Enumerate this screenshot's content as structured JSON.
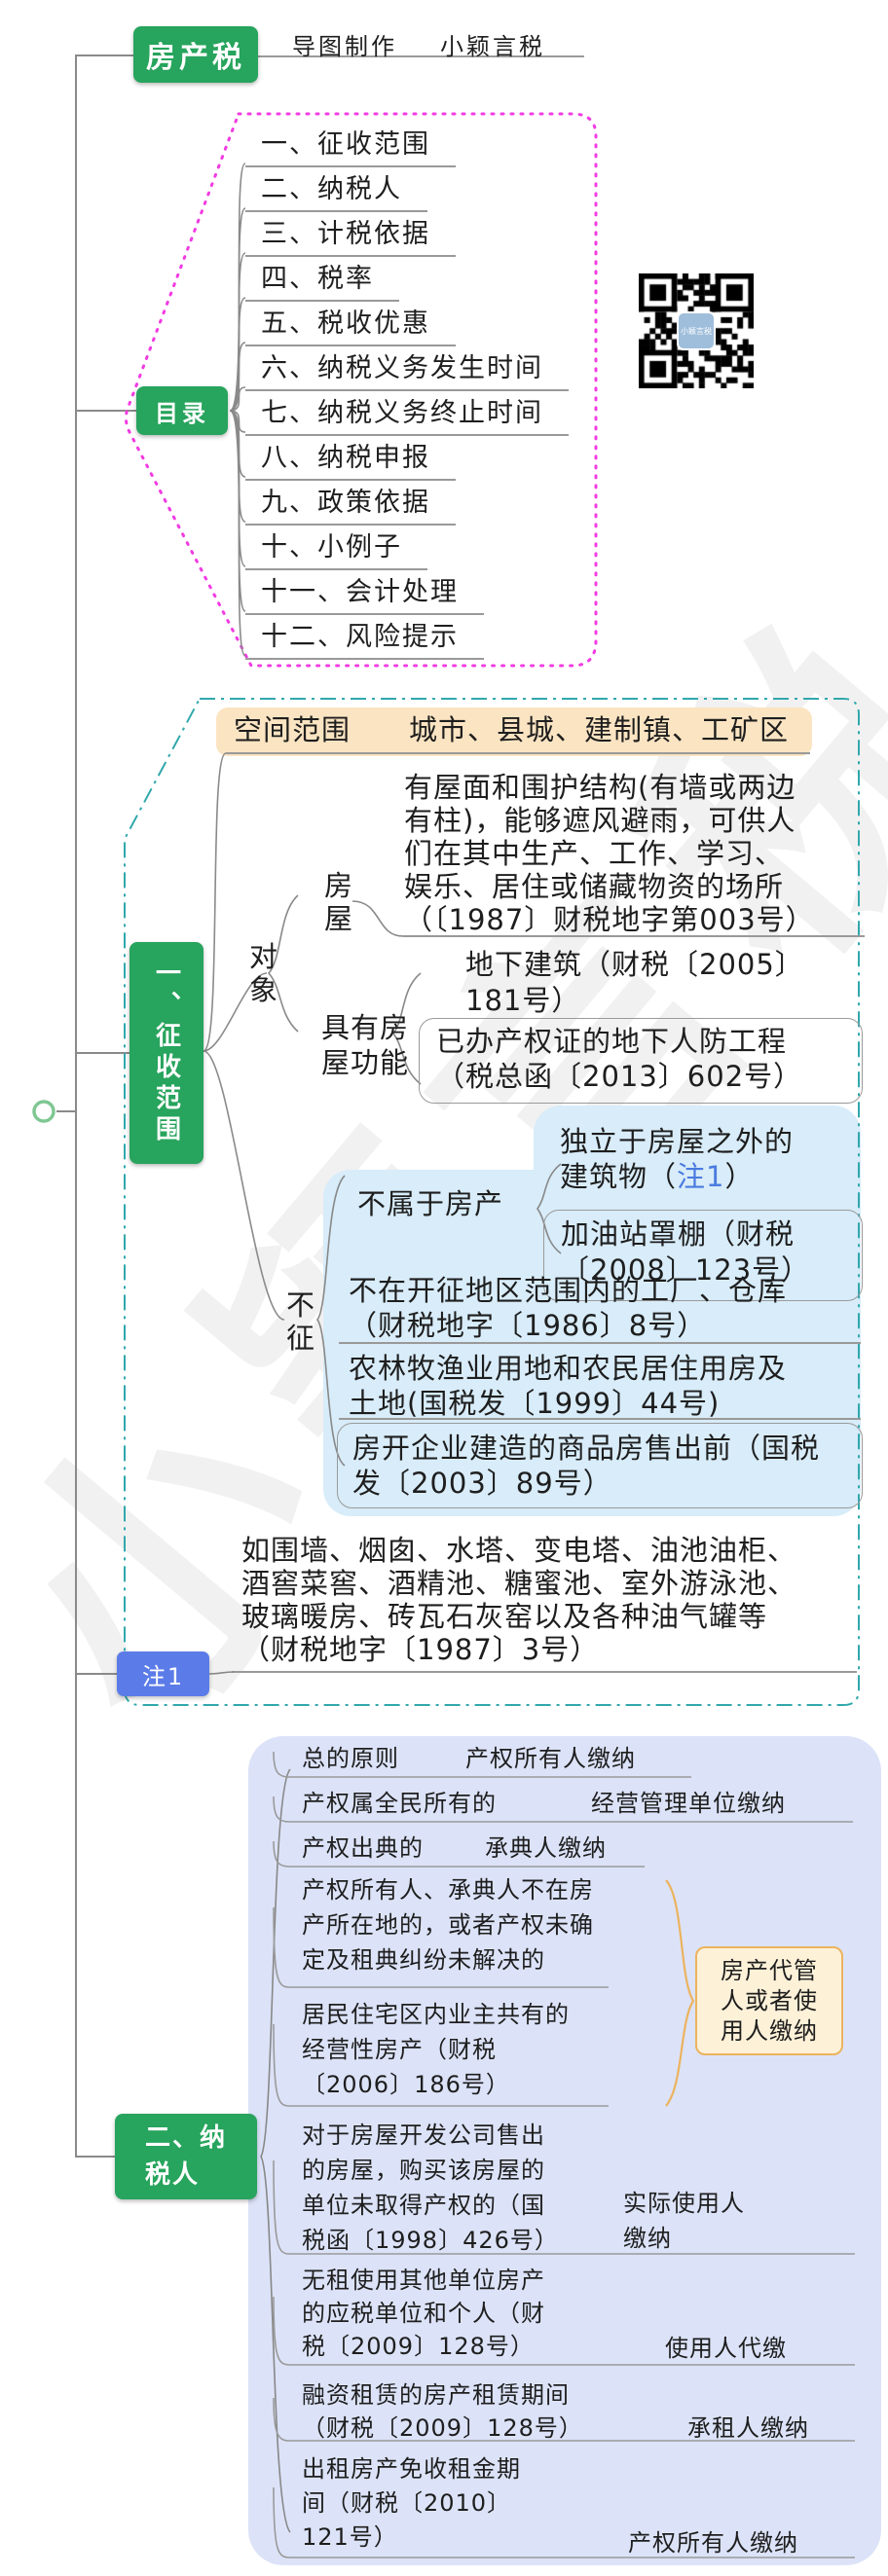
{
  "page": {
    "watermark": "小颖言税"
  },
  "root_node": {
    "label": "房产税"
  },
  "credit": {
    "label": "导图制作",
    "value": "小颖言税"
  },
  "qr_code": {
    "label": "小颖言税"
  },
  "toc": {
    "label": "目录",
    "items": [
      "一、征收范围",
      "二、纳税人",
      "三、计税依据",
      "四、税率",
      "五、税收优惠",
      "六、纳税义务发生时间",
      "七、纳税义务终止时间",
      "八、纳税申报",
      "九、政策依据",
      "十、小例子",
      "十一、会计处理",
      "十二、风险提示"
    ]
  },
  "s1": {
    "label": "一、征收范围",
    "space_label": "空间范围",
    "space_value": "城市、县城、建制镇、工矿区",
    "object_label": "对象",
    "house_label": "房屋",
    "house_text": [
      "有屋面和围护结构(有墙或两边",
      "有柱)，能够遮风避雨，可供人",
      "们在其中生产、工作、学习、",
      "娱乐、居住或储藏物资的场所",
      "（〔1987〕财税地字第003号）"
    ],
    "func_label": "具有房屋功能",
    "underground": [
      "地下建筑（财税〔2005〕",
      "181号）"
    ],
    "civil_defense": [
      "已办产权证的地下人防工程",
      "（税总函〔2013〕602号）"
    ],
    "excl_label": "不征",
    "not_property_label": "不属于房产",
    "independent": {
      "line1": "独立于房屋之外的",
      "line2_pre": "建筑物（",
      "ref": "注1",
      "line2_suf": "）"
    },
    "gas_station": [
      "加油站罩棚（财税",
      "〔2008〕123号）"
    ],
    "factory": [
      "不在开征地区范围内的工厂、仓库",
      "（财税地字〔1986〕8号）"
    ],
    "farm": [
      "农林牧渔业用地和农民居住用房及",
      "土地(国税发〔1999〕44号)"
    ],
    "developer": [
      "房开企业建造的商品房售出前（国税",
      "发〔2003〕89号）"
    ]
  },
  "note1": {
    "label": "注1",
    "text": [
      "如围墙、烟囱、水塔、变电塔、油池油柜、",
      "酒窖菜窖、酒精池、糖蜜池、室外游泳池、",
      "玻璃暖房、砖瓦石灰窑以及各种油气罐等",
      "（财税地字〔1987〕3号）"
    ]
  },
  "s2": {
    "label": "二、纳税人",
    "shared_payer": "房产代管人或者使用人缴纳",
    "rows": [
      {
        "c": "总的原则",
        "p": "产权所有人缴纳"
      },
      {
        "c": "产权属全民所有的",
        "p": "经营管理单位缴纳"
      },
      {
        "c": "产权出典的",
        "p": "承典人缴纳"
      },
      {
        "c": [
          "产权所有人、承典人不在房",
          "产所在地的，或者产权未确",
          "定及租典纠纷未解决的"
        ],
        "p": ""
      },
      {
        "c": [
          "居民住宅区内业主共有的",
          "经营性房产（财税",
          "〔2006〕186号）"
        ],
        "p": ""
      },
      {
        "c": [
          "对于房屋开发公司售出",
          "的房屋，购买该房屋的",
          "单位未取得产权的（国",
          "税函〔1998〕426号）"
        ],
        "p": "实际使用人缴纳"
      },
      {
        "c": [
          "无租使用其他单位房产",
          "的应税单位和个人（财",
          "税〔2009〕128号）"
        ],
        "p": "使用人代缴"
      },
      {
        "c": [
          "融资租赁的房产租赁期间",
          "（财税〔2009〕128号）"
        ],
        "p": "承租人缴纳"
      },
      {
        "c": [
          "出租房产免收租金期",
          "间（财税〔2010〕",
          "121号）"
        ],
        "p": "产权所有人缴纳"
      }
    ]
  },
  "colors": {
    "node_green": "#27a45d",
    "boundary_magenta": "#f23be2",
    "boundary_teal": "#31a8ac",
    "highlight_peach": "#fbe4c2",
    "cloud_blue": "#d8ecf9",
    "cloud_lavender": "#dce3f8",
    "note_box_blue": "#5b7ce8",
    "ref_blue": "#4a7be0",
    "callout_cream": "#fdf1d8",
    "callout_border": "#ecb35f"
  }
}
